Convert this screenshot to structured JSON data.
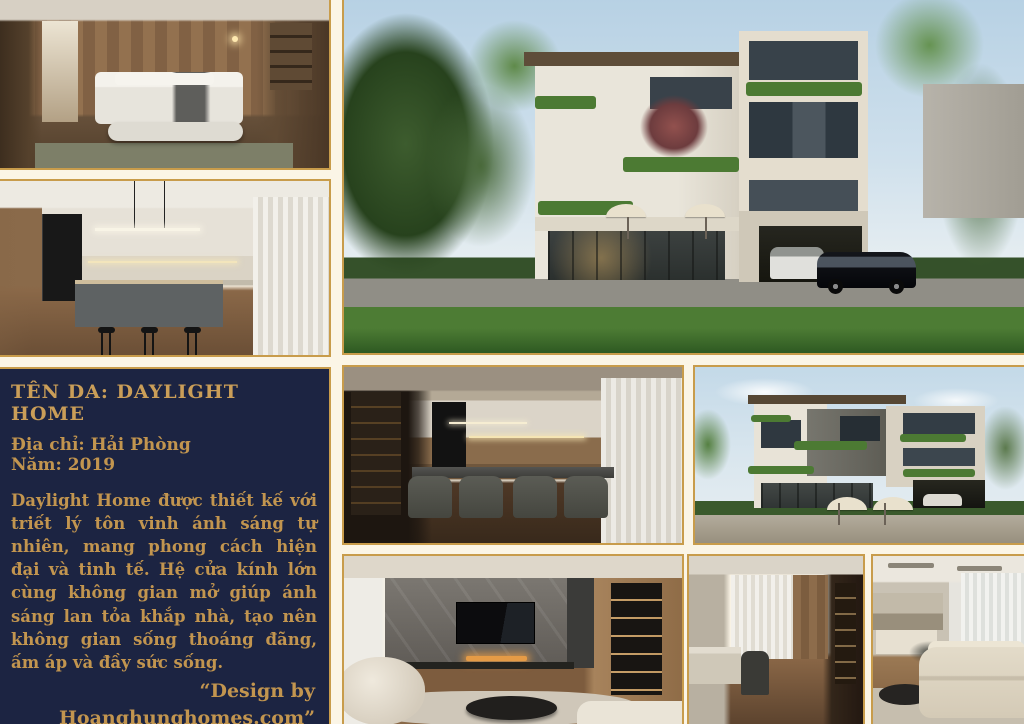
{
  "page": {
    "background_color": "#FBF5E6",
    "border_gold": "#C89C4B",
    "panel_navy": "#1C2442",
    "text_gold": "#C2954F"
  },
  "info_panel": {
    "title": "TÊN DA: DAYLIGHT HOME",
    "address": "Địa chỉ: Hải Phòng",
    "year": "Năm: 2019",
    "description": "Daylight Home được thiết kế với triết lý tôn vinh ánh sáng tự nhiên, mang phong cách hiện đại và tinh tế. Hệ cửa kính lớn cùng không gian mở giúp ánh sáng lan tỏa khắp nhà, tạo nên không gian sống thoáng đãng, ấm áp và đầy sức sống.",
    "credit": "“Design by Hoanghunghomes.com”"
  },
  "photo_labels": {
    "bedroom": "master bedroom render",
    "kitchen": "kitchen island render",
    "exterior_main": "villa street view render",
    "dining": "dining room render",
    "exterior_side": "villa corner view render",
    "living_tv": "living room stone TV wall render",
    "hallway": "hallway and pantry render",
    "living_sofa": "living room sectional sofa render"
  }
}
